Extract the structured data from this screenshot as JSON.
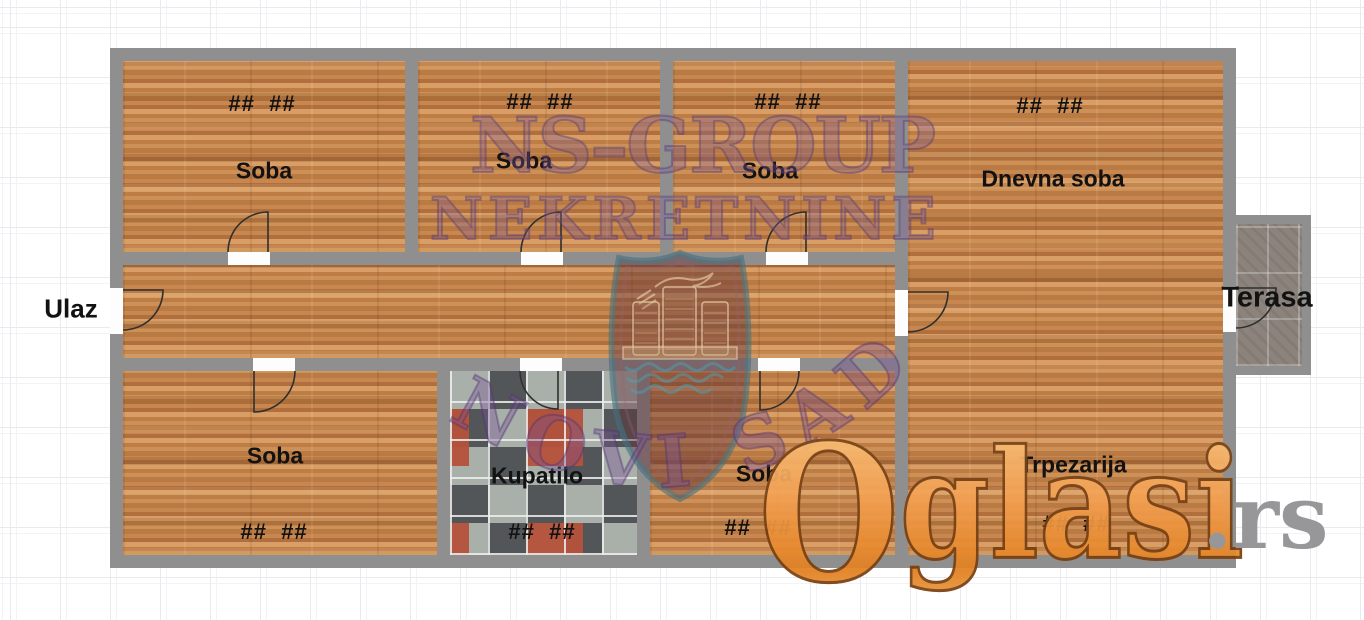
{
  "plan": {
    "entrance_label": "Ulaz",
    "terrace_label": "Terasa",
    "rooms": [
      {
        "id": "soba-1",
        "name": "Soba",
        "dims": "##  ##"
      },
      {
        "id": "soba-2",
        "name": "Soba",
        "dims": "##  ##"
      },
      {
        "id": "soba-3",
        "name": "Soba",
        "dims": "##  ##"
      },
      {
        "id": "dnevna-soba",
        "name": "Dnevna soba",
        "dims": "##  ##"
      },
      {
        "id": "soba-4",
        "name": "Soba",
        "dims": "##  ##"
      },
      {
        "id": "kupatilo",
        "name": "Kupatilo",
        "dims": "##  ##"
      },
      {
        "id": "soba-5",
        "name": "Soba",
        "dims": "##  ##"
      },
      {
        "id": "trpezarija",
        "name": "Trpezarija",
        "dims": "##  ##"
      }
    ]
  },
  "watermarks": {
    "agency_line1": "NS–GROUP",
    "agency_line2": "NEKRETNINE",
    "city": "NOVI SAD",
    "portal": "Oglasi",
    "portal_tld": ".rs"
  },
  "colors": {
    "wall_gray": "#8f8f8f",
    "wood_floor": "#c08049",
    "terrace_floor": "#8b837c",
    "tile_dark": "#4c4e52",
    "tile_red": "#b5523a",
    "watermark_purple": "#785596",
    "portal_orange": "#ef9440",
    "portal_tld_gray": "#97979a"
  }
}
